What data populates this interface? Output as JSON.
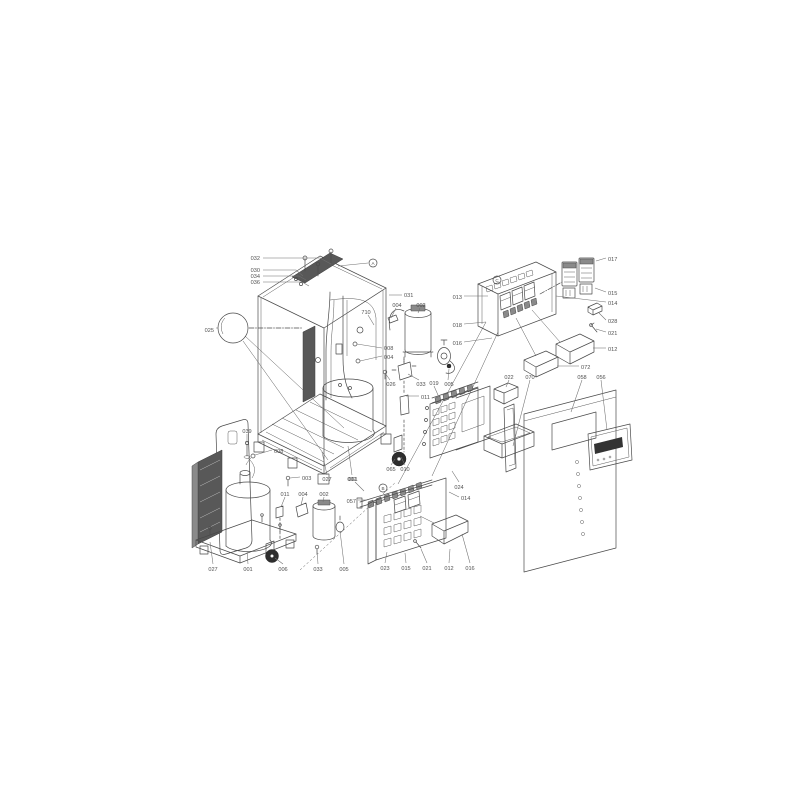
{
  "meta": {
    "title": "exploded-parts-diagram",
    "description": "isometric exploded view of outdoor unit with part number callouts"
  },
  "colors": {
    "background": "#ffffff",
    "line": "#4a4a4a",
    "label": "#515151",
    "dark_fill": "#585858",
    "wheel": "#2e2e2e"
  },
  "markers": [
    {
      "letter": "A",
      "x": 373,
      "y": 263,
      "line": [
        [
          368,
          263
        ],
        [
          338,
          266
        ]
      ]
    },
    {
      "letter": "C",
      "x": 497,
      "y": 280
    },
    {
      "letter": "B",
      "x": 383,
      "y": 488
    }
  ],
  "callouts": [
    {
      "label": "032",
      "x": 260,
      "y": 258,
      "anchor": "end",
      "leader": [
        [
          263,
          258
        ],
        [
          320,
          258
        ],
        [
          331,
          264
        ]
      ]
    },
    {
      "label": "030",
      "x": 260,
      "y": 270,
      "anchor": "end",
      "leader": [
        [
          263,
          270
        ],
        [
          296,
          270
        ],
        [
          303,
          276
        ]
      ]
    },
    {
      "label": "034",
      "x": 260,
      "y": 276,
      "anchor": "end",
      "leader": [
        [
          263,
          276
        ],
        [
          299,
          276
        ],
        [
          306,
          280
        ]
      ]
    },
    {
      "label": "036",
      "x": 260,
      "y": 282,
      "anchor": "end",
      "leader": [
        [
          263,
          282
        ],
        [
          302,
          282
        ],
        [
          309,
          286
        ]
      ]
    },
    {
      "label": "025",
      "x": 214,
      "y": 330,
      "anchor": "end",
      "leader": [
        [
          216,
          328
        ],
        [
          218,
          328
        ]
      ]
    },
    {
      "label": "031",
      "x": 404,
      "y": 295,
      "anchor": "start",
      "leader": [
        [
          402,
          295
        ],
        [
          389,
          295
        ]
      ]
    },
    {
      "label": "710",
      "x": 366,
      "y": 312,
      "anchor": "middle",
      "leader": [
        [
          368,
          315
        ],
        [
          374,
          325
        ]
      ]
    },
    {
      "label": "004",
      "x": 397,
      "y": 305,
      "anchor": "middle",
      "leader": [
        [
          396,
          308
        ],
        [
          391,
          318
        ]
      ]
    },
    {
      "label": "002",
      "x": 421,
      "y": 305,
      "anchor": "middle",
      "leader": [
        [
          420,
          308
        ],
        [
          418,
          313
        ]
      ]
    },
    {
      "label": "008",
      "x": 384,
      "y": 348,
      "anchor": "start",
      "leader": [
        [
          382,
          348
        ],
        [
          357,
          344
        ]
      ]
    },
    {
      "label": "004",
      "x": 384,
      "y": 357,
      "anchor": "start",
      "leader": [
        [
          382,
          356
        ],
        [
          360,
          361
        ]
      ]
    },
    {
      "label": "026",
      "x": 391,
      "y": 384,
      "anchor": "middle",
      "leader": [
        [
          390,
          380
        ],
        [
          385,
          373
        ]
      ]
    },
    {
      "label": "033",
      "x": 421,
      "y": 384,
      "anchor": "middle",
      "leader": [
        [
          419,
          380
        ],
        [
          408,
          374
        ]
      ]
    },
    {
      "label": "005",
      "x": 449,
      "y": 384,
      "anchor": "middle",
      "leader": [
        [
          448,
          380
        ],
        [
          449,
          369
        ]
      ]
    },
    {
      "label": "011",
      "x": 421,
      "y": 397,
      "anchor": "start",
      "leader": [
        [
          419,
          396
        ],
        [
          406,
          396
        ]
      ]
    },
    {
      "label": "065",
      "x": 391,
      "y": 469,
      "anchor": "middle",
      "leader": [
        [
          391,
          465
        ],
        [
          395,
          459
        ]
      ]
    },
    {
      "label": "010",
      "x": 405,
      "y": 469,
      "anchor": "middle",
      "leader": [
        [
          405,
          465
        ],
        [
          401,
          457
        ]
      ]
    },
    {
      "label": "027",
      "x": 327,
      "y": 479,
      "anchor": "middle",
      "leader": [
        [
          327,
          475
        ],
        [
          322,
          452
        ]
      ]
    },
    {
      "label": "001",
      "x": 352,
      "y": 479,
      "anchor": "middle",
      "leader": [
        [
          352,
          475
        ],
        [
          348,
          446
        ]
      ]
    },
    {
      "label": "039",
      "x": 247,
      "y": 431,
      "anchor": "middle",
      "leader": [
        [
          247,
          434
        ],
        [
          247,
          443
        ]
      ]
    },
    {
      "label": "008",
      "x": 274,
      "y": 451,
      "anchor": "start",
      "leader": [
        [
          272,
          450
        ],
        [
          255,
          455
        ]
      ]
    },
    {
      "label": "003",
      "x": 302,
      "y": 478,
      "anchor": "start",
      "leader": [
        [
          300,
          477
        ],
        [
          290,
          478
        ]
      ]
    },
    {
      "label": "011",
      "x": 285,
      "y": 494,
      "anchor": "middle",
      "leader": [
        [
          285,
          497
        ],
        [
          281,
          507
        ]
      ]
    },
    {
      "label": "004",
      "x": 303,
      "y": 494,
      "anchor": "middle",
      "leader": [
        [
          303,
          497
        ],
        [
          301,
          505
        ]
      ]
    },
    {
      "label": "002",
      "x": 324,
      "y": 494,
      "anchor": "middle",
      "leader": [
        [
          324,
          497
        ],
        [
          323,
          502
        ]
      ]
    },
    {
      "label": "027",
      "x": 213,
      "y": 569,
      "anchor": "middle",
      "leader": [
        [
          213,
          564
        ],
        [
          210,
          542
        ]
      ]
    },
    {
      "label": "001",
      "x": 248,
      "y": 569,
      "anchor": "middle",
      "leader": [
        [
          248,
          564
        ],
        [
          247,
          551
        ]
      ]
    },
    {
      "label": "006",
      "x": 283,
      "y": 569,
      "anchor": "middle",
      "leader": [
        [
          283,
          564
        ],
        [
          275,
          558
        ]
      ]
    },
    {
      "label": "033",
      "x": 318,
      "y": 569,
      "anchor": "middle",
      "leader": [
        [
          318,
          564
        ],
        [
          317,
          549
        ]
      ]
    },
    {
      "label": "005",
      "x": 344,
      "y": 569,
      "anchor": "middle",
      "leader": [
        [
          344,
          564
        ],
        [
          340,
          531
        ]
      ]
    },
    {
      "label": "013",
      "x": 462,
      "y": 297,
      "anchor": "end",
      "leader": [
        [
          464,
          296
        ],
        [
          488,
          296
        ]
      ]
    },
    {
      "label": "018",
      "x": 462,
      "y": 325,
      "anchor": "end",
      "leader": [
        [
          464,
          324
        ],
        [
          486,
          322
        ]
      ]
    },
    {
      "label": "016",
      "x": 462,
      "y": 343,
      "anchor": "end",
      "leader": [
        [
          464,
          342
        ],
        [
          492,
          338
        ]
      ]
    },
    {
      "label": "017",
      "x": 608,
      "y": 259,
      "anchor": "start",
      "leader": [
        [
          606,
          258
        ],
        [
          596,
          261
        ]
      ]
    },
    {
      "label": "015",
      "x": 608,
      "y": 293,
      "anchor": "start",
      "leader": [
        [
          606,
          292
        ],
        [
          595,
          288
        ]
      ]
    },
    {
      "label": "014",
      "x": 608,
      "y": 303,
      "anchor": "start",
      "leader": [
        [
          606,
          302
        ],
        [
          556,
          296
        ]
      ]
    },
    {
      "label": "028",
      "x": 608,
      "y": 321,
      "anchor": "start",
      "leader": [
        [
          606,
          320
        ],
        [
          599,
          313
        ]
      ]
    },
    {
      "label": "021",
      "x": 608,
      "y": 333,
      "anchor": "start",
      "leader": [
        [
          606,
          332
        ],
        [
          596,
          329
        ]
      ]
    },
    {
      "label": "012",
      "x": 608,
      "y": 349,
      "anchor": "start",
      "leader": [
        [
          606,
          348
        ],
        [
          593,
          348
        ]
      ]
    },
    {
      "label": "072",
      "x": 581,
      "y": 367,
      "anchor": "start",
      "leader": [
        [
          579,
          366
        ],
        [
          557,
          366
        ]
      ]
    },
    {
      "label": "022",
      "x": 509,
      "y": 377,
      "anchor": "middle",
      "leader": [
        [
          509,
          380
        ],
        [
          506,
          387
        ]
      ]
    },
    {
      "label": "070",
      "x": 530,
      "y": 377,
      "anchor": "middle",
      "leader": [
        [
          530,
          380
        ],
        [
          513,
          446
        ]
      ]
    },
    {
      "label": "058",
      "x": 582,
      "y": 377,
      "anchor": "middle",
      "leader": [
        [
          582,
          380
        ],
        [
          571,
          412
        ]
      ]
    },
    {
      "label": "056",
      "x": 601,
      "y": 377,
      "anchor": "middle",
      "leader": [
        [
          601,
          380
        ],
        [
          607,
          430
        ]
      ]
    },
    {
      "label": "019",
      "x": 434,
      "y": 383,
      "anchor": "middle",
      "leader": [
        [
          434,
          386
        ],
        [
          438,
          395
        ]
      ]
    },
    {
      "label": "024",
      "x": 459,
      "y": 487,
      "anchor": "middle",
      "leader": [
        [
          459,
          482
        ],
        [
          452,
          471
        ]
      ]
    },
    {
      "label": "014",
      "x": 461,
      "y": 498,
      "anchor": "start",
      "leader": [
        [
          459,
          497
        ],
        [
          449,
          492
        ]
      ]
    },
    {
      "label": "061",
      "x": 353,
      "y": 479,
      "anchor": "middle",
      "leader": [
        [
          355,
          482
        ],
        [
          364,
          491
        ]
      ]
    },
    {
      "label": "057",
      "x": 356,
      "y": 501,
      "anchor": "end",
      "leader": [
        [
          358,
          500
        ],
        [
          366,
          500
        ]
      ]
    },
    {
      "label": "023",
      "x": 385,
      "y": 568,
      "anchor": "middle",
      "leader": [
        [
          385,
          563
        ],
        [
          387,
          552
        ]
      ]
    },
    {
      "label": "015",
      "x": 406,
      "y": 568,
      "anchor": "middle",
      "leader": [
        [
          406,
          563
        ],
        [
          405,
          553
        ]
      ]
    },
    {
      "label": "021",
      "x": 427,
      "y": 568,
      "anchor": "middle",
      "leader": [
        [
          427,
          563
        ],
        [
          421,
          549
        ]
      ]
    },
    {
      "label": "012",
      "x": 449,
      "y": 568,
      "anchor": "middle",
      "leader": [
        [
          449,
          563
        ],
        [
          450,
          549
        ]
      ]
    },
    {
      "label": "016",
      "x": 470,
      "y": 568,
      "anchor": "middle",
      "leader": [
        [
          470,
          563
        ],
        [
          462,
          534
        ]
      ]
    }
  ]
}
